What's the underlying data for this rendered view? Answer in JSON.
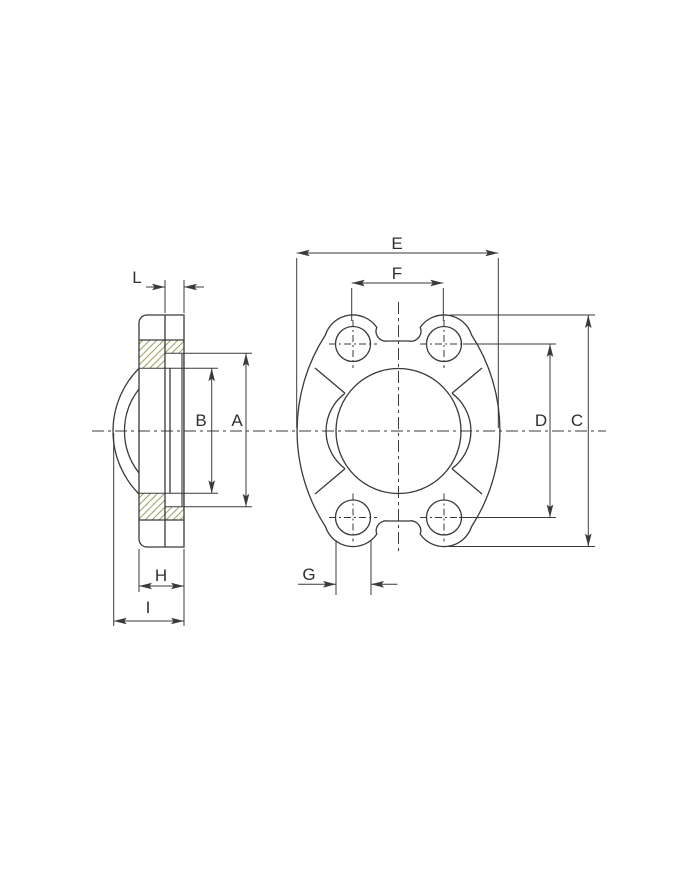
{
  "drawing": {
    "colors": {
      "line": "#3a3a3a",
      "hatch": "#a3a36b",
      "face_highlight": "#8f8f8f",
      "background": "#ffffff"
    },
    "side_view": {
      "labels": {
        "L": "L",
        "B": "B",
        "A": "A",
        "H": "H",
        "I": "I"
      }
    },
    "front_view": {
      "labels": {
        "E": "E",
        "F": "F",
        "C": "C",
        "D": "D",
        "G": "G"
      }
    }
  }
}
